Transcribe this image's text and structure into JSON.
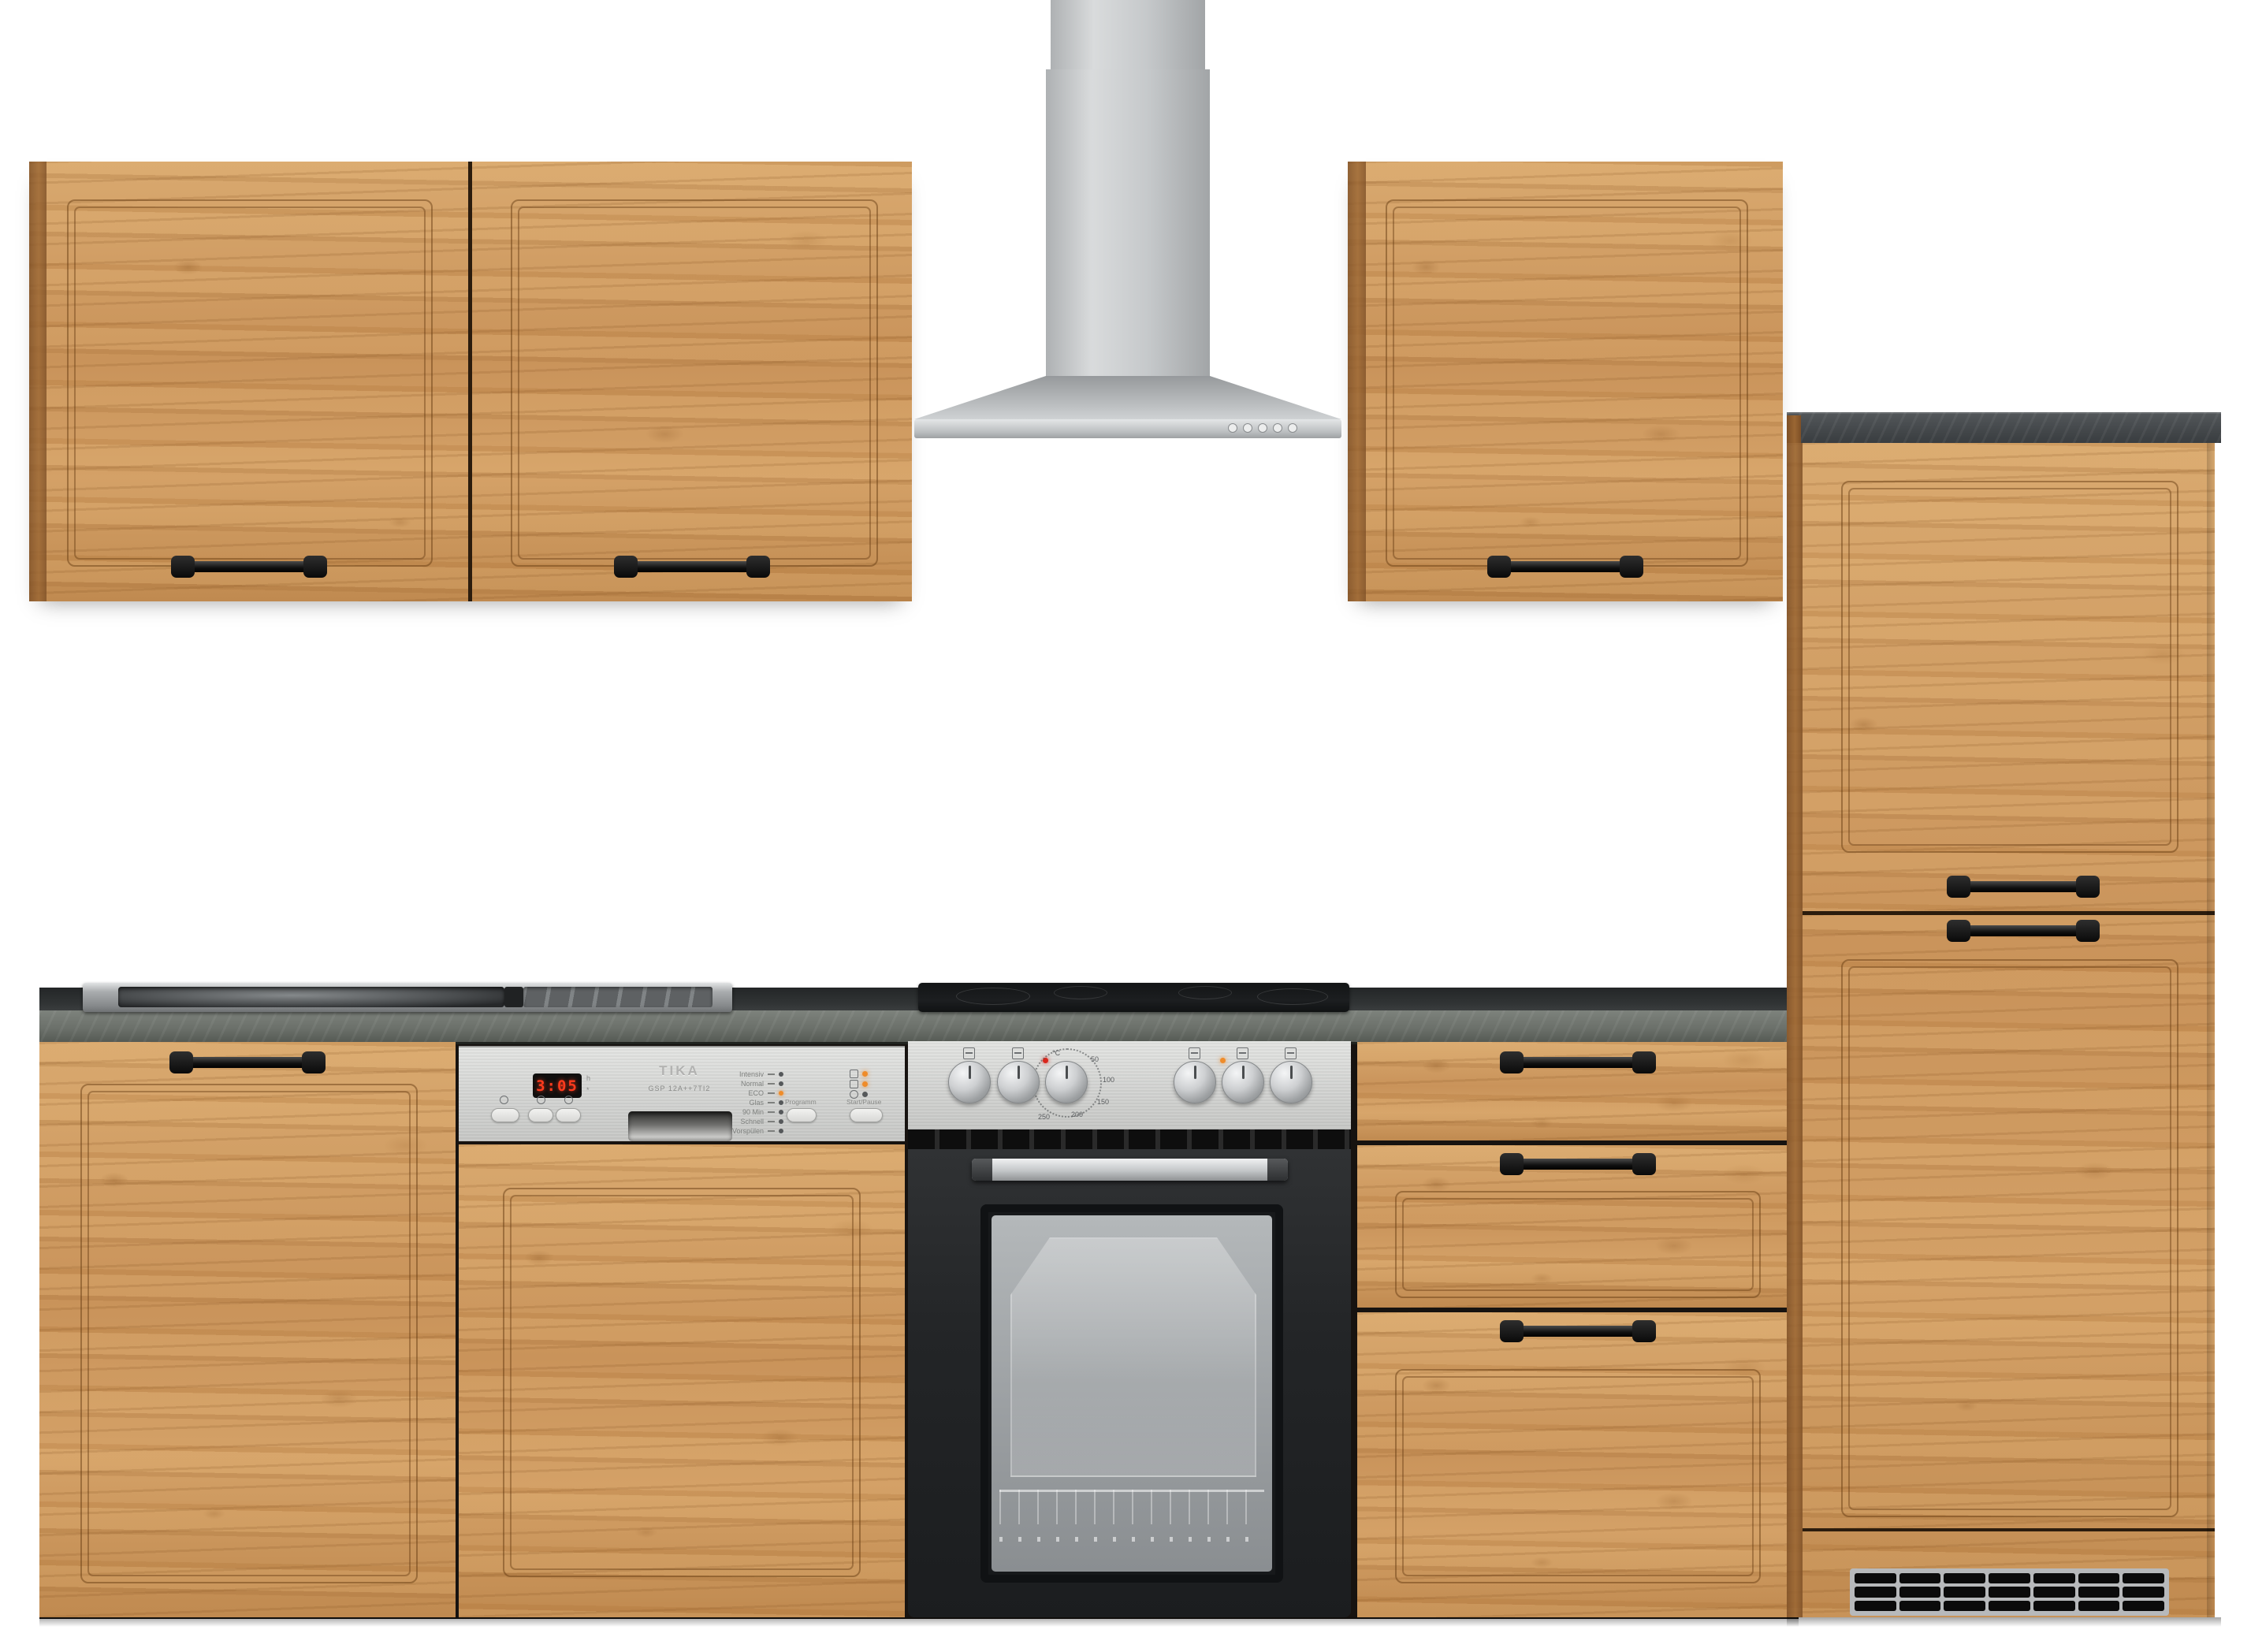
{
  "scene": {
    "background": "#ffffff"
  },
  "palette": {
    "wood": "#cf9a63",
    "wood_dark": "#7d4f26",
    "counter_face": "#70756f",
    "counter_top": "#2d3031",
    "steel": "#c8cacc",
    "slab_concrete": "#44484b",
    "handle_black": "#141414",
    "led_red": "#d9261c",
    "led_orange": "#ef8c2a"
  },
  "hood": {
    "button_count": 5
  },
  "dishwasher": {
    "display_value": "3:05",
    "aux_top": "h",
    "aux_bottom": "*",
    "brand": "TIKA",
    "model": "GSP 12A++7TI2",
    "programs": [
      "Intensiv",
      "Normal",
      "ECO",
      "Glas",
      "90 Min",
      "Schnell",
      "Vorspülen"
    ],
    "active_program": "ECO",
    "program_button": "Programm",
    "start_button": "Start/Pause"
  },
  "oven": {
    "dial_unit": "°C",
    "dial_temps": [
      "50",
      "100",
      "150",
      "200",
      "250"
    ]
  }
}
